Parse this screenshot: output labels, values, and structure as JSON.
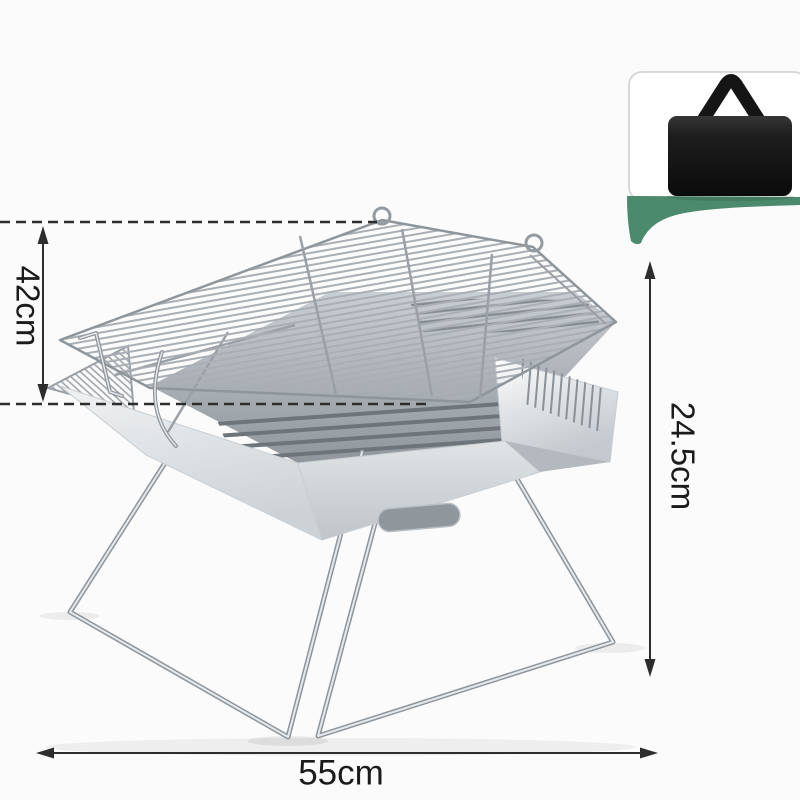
{
  "annotations": {
    "grate_width_label": "42cm",
    "height_label": "24.5cm",
    "base_width_label": "55cm"
  },
  "inset": {
    "item": "carry-bag-icon"
  },
  "colors": {
    "background": "#fbfbfb",
    "accent_green": "#4b8a6d",
    "bag_black": "#141414",
    "dimension_line": "#2d2d2d",
    "metal_light": "#eef0f2",
    "metal_mid": "#c6cbcf",
    "metal_dark": "#8f969b"
  }
}
